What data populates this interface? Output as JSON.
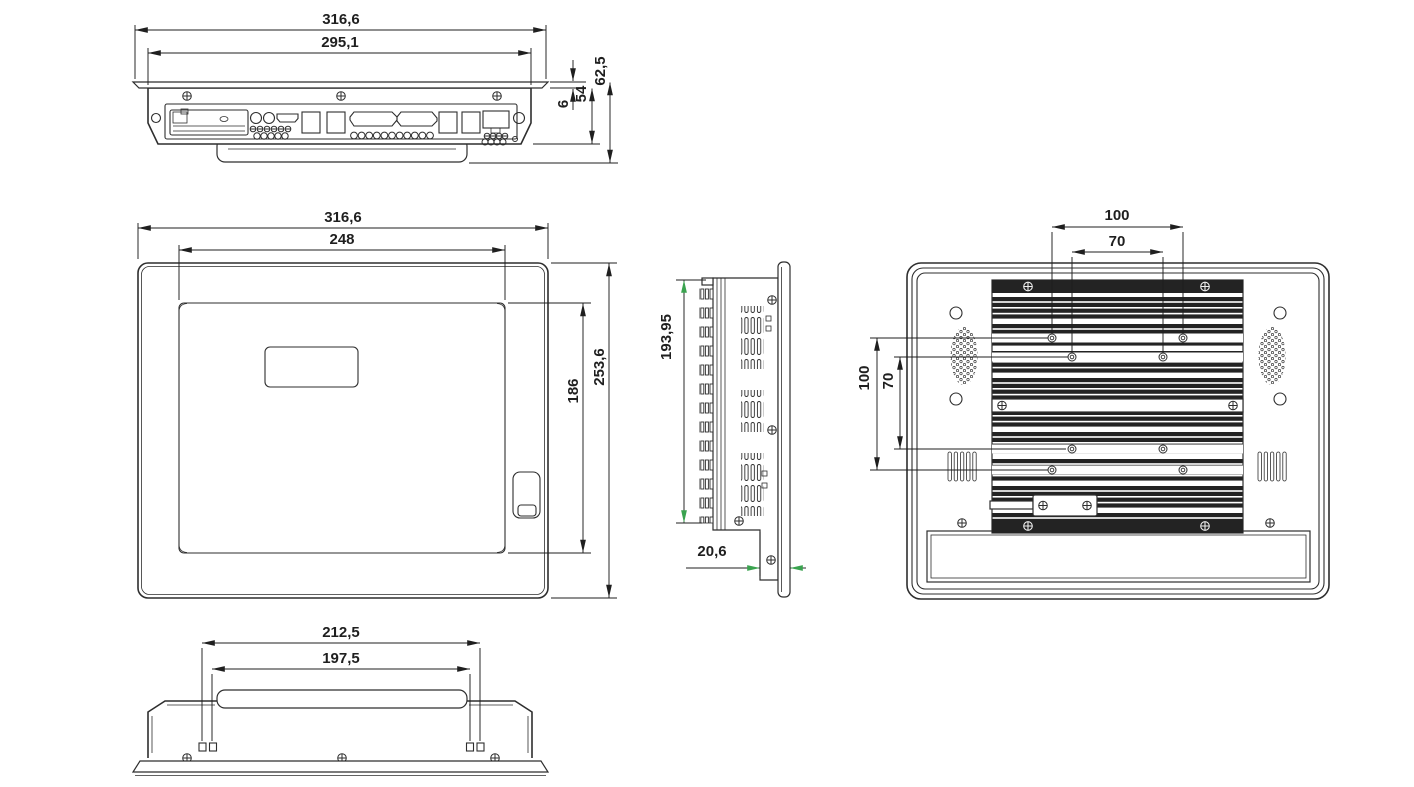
{
  "drawing_title": "panel-pc-multiview-dimension-drawing",
  "views": {
    "top": {
      "dims": {
        "overall_width": "316,6",
        "body_width": "295,1",
        "flange_thickness": "6",
        "body_depth": "54",
        "overall_depth": "62,5"
      }
    },
    "front": {
      "dims": {
        "overall_width": "316,6",
        "display_width": "248",
        "overall_height": "253,6",
        "display_height": "186"
      }
    },
    "side": {
      "dims": {
        "rear_section_height": "193,95",
        "front_depth": "20,6"
      }
    },
    "rear": {
      "dims": {
        "vesa_width_outer": "100",
        "vesa_width_inner": "70",
        "vesa_height_outer": "100",
        "vesa_height_inner": "70"
      }
    },
    "bottom": {
      "dims": {
        "bracket_outer_width": "212,5",
        "bracket_inner_width": "197,5"
      }
    }
  },
  "colors": {
    "line": "#2e2e2e",
    "dim": "#1f1f1f",
    "accent_arrow": "#3aa34f",
    "dark_fill": "#232323",
    "background": "#ffffff"
  }
}
